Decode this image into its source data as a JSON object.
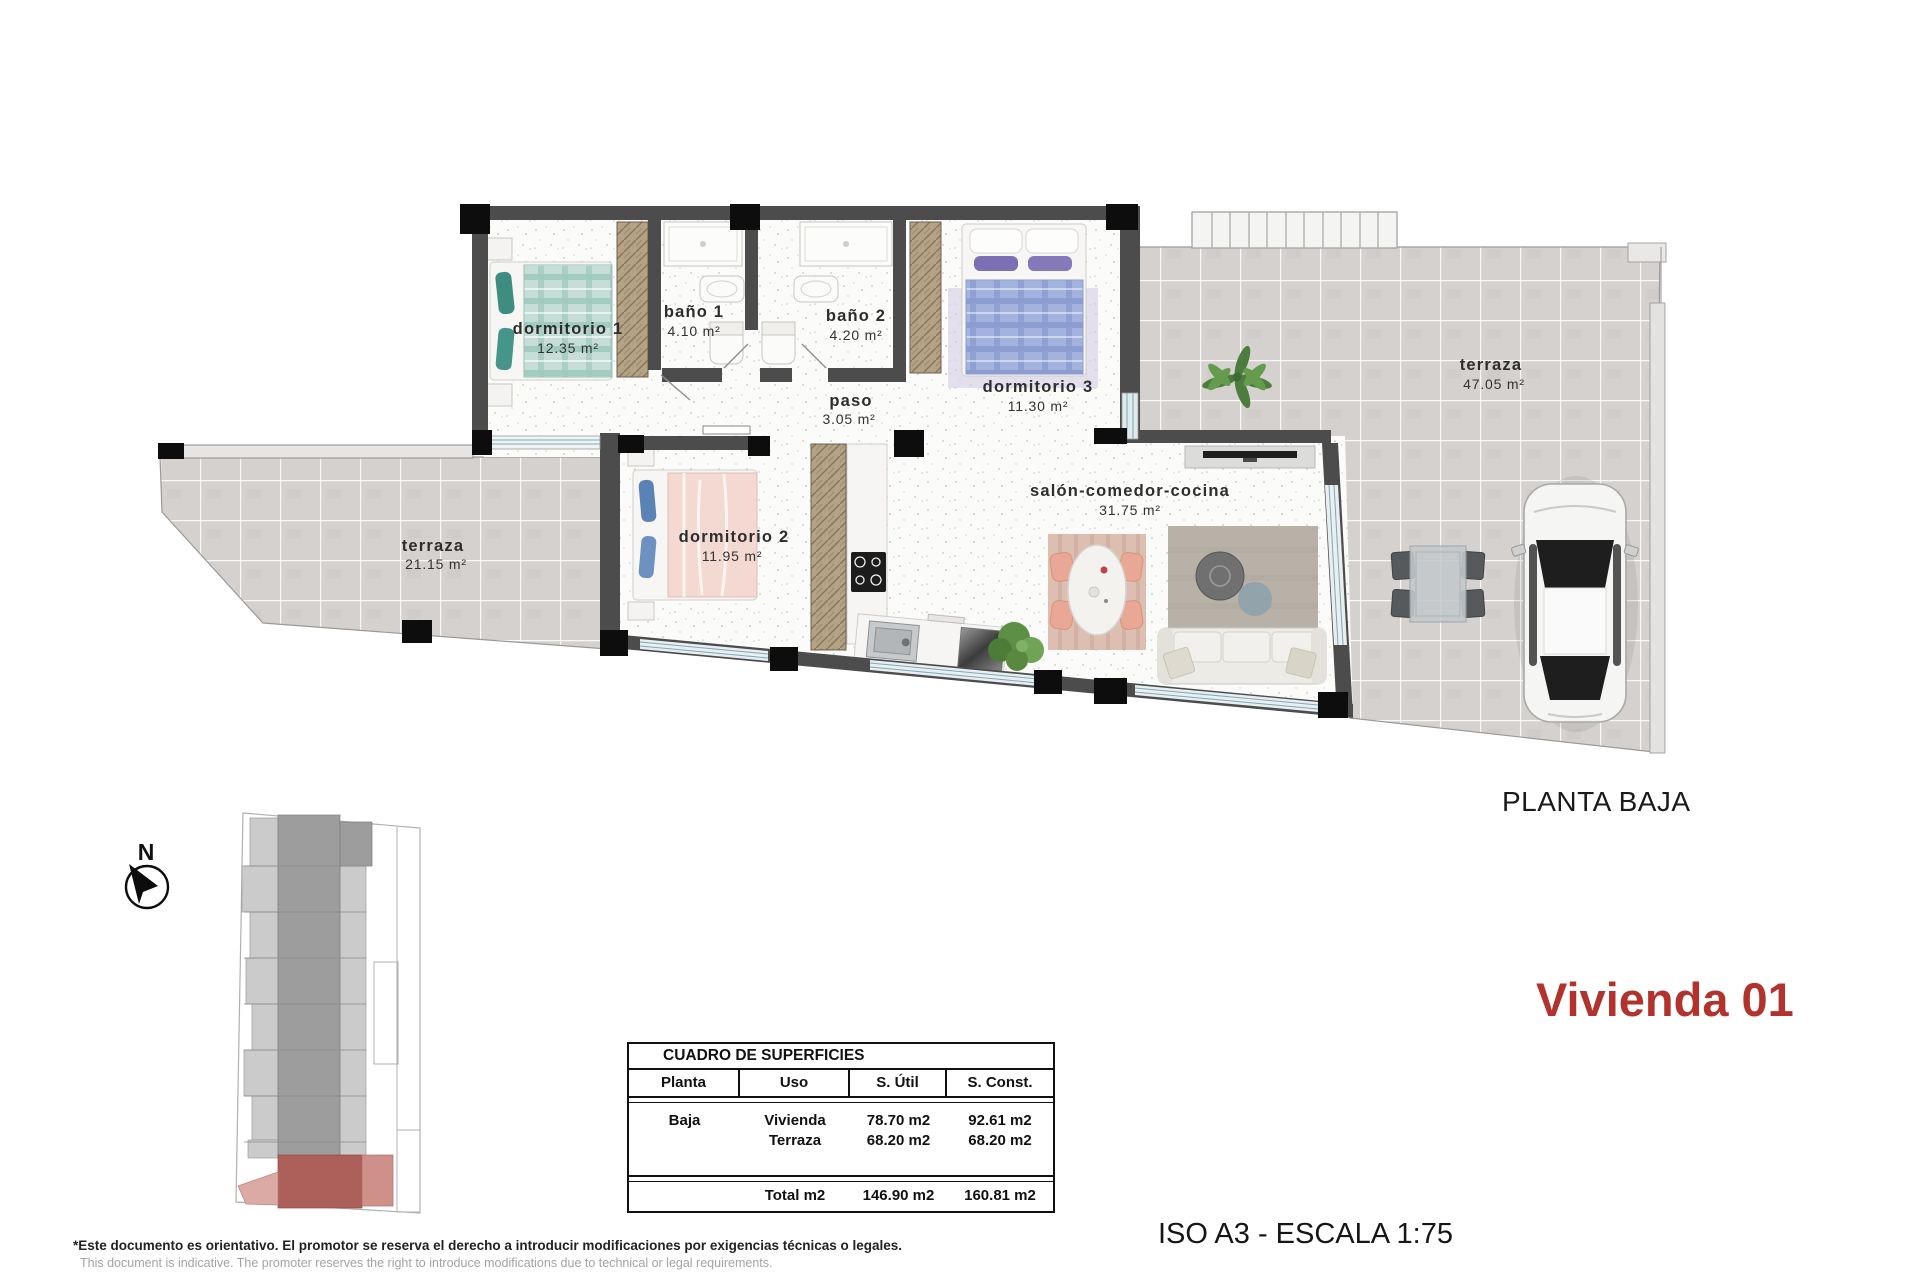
{
  "colors": {
    "accent_red": "#b2332e",
    "wall_dark": "#4c4c4c",
    "terrace_tile": "#d4d1ce"
  },
  "plan": {
    "compass_label": "N",
    "rooms": [
      {
        "label": "dormitorio 1",
        "area": "12.35 m²"
      },
      {
        "label": "baño 1",
        "area": "4.10 m²"
      },
      {
        "label": "baño 2",
        "area": "4.20 m²"
      },
      {
        "label": "paso",
        "area": "3.05 m²"
      },
      {
        "label": "dormitorio 3",
        "area": "11.30 m²"
      },
      {
        "label": "dormitorio 2",
        "area": "11.95 m²"
      },
      {
        "label": "salón-comedor-cocina",
        "area": "31.75 m²"
      },
      {
        "label": "terraza",
        "area": "21.15 m²"
      },
      {
        "label": "terraza",
        "area": "47.05 m²"
      }
    ]
  },
  "titles": {
    "floor_label": "PLANTA BAJA",
    "unit_label": "Vivienda 01",
    "scale_label": "ISO A3 - ESCALA 1:75"
  },
  "surface_table": {
    "title": "CUADRO DE SUPERFICIES",
    "headers": [
      "Planta",
      "Uso",
      "S. Útil",
      "S. Const."
    ],
    "rows": [
      {
        "planta": "Baja",
        "uso": "Vivienda",
        "util": "78.70 m2",
        "const": "92.61 m2"
      },
      {
        "planta": "",
        "uso": "Terraza",
        "util": "68.20 m2",
        "const": "68.20 m2"
      }
    ],
    "total": {
      "planta": "",
      "label": "Total m2",
      "util": "146.90 m2",
      "const": "160.81 m2"
    }
  },
  "footer": {
    "disclaimer_es": "*Este documento es orientativo. El promotor se reserva el derecho a introducir modificaciones por exigencias técnicas o legales.",
    "disclaimer_en": "This document is indicative. The promoter reserves the right to introduce modifications due to technical or legal requirements."
  }
}
